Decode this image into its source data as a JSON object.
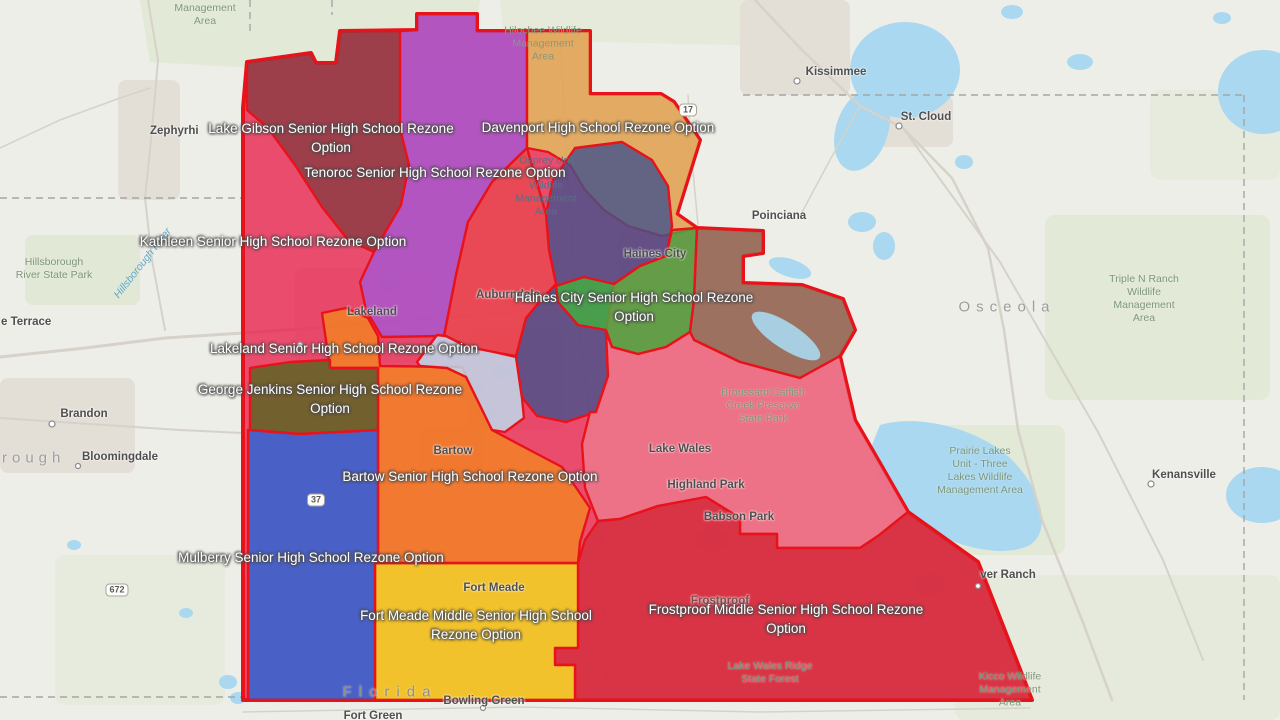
{
  "map": {
    "title": "Polk County school rezone options map",
    "colors": {
      "background": "#edeee7",
      "water": "#a9d8f0",
      "zone_border": "#e8121b",
      "green_area": "#dfe7d3",
      "urban_area": "#e3dfd7",
      "road": "#d6d2c9"
    },
    "zones": [
      {
        "id": "kathleen",
        "name": "Kathleen Senior High School Rezone Option",
        "color": "#e8234f"
      },
      {
        "id": "lake-gibson",
        "name": "Lake Gibson Senior High School Rezone Option",
        "color": "#8a3c42"
      },
      {
        "id": "tenoroc",
        "name": "Tenoroc Senior High School Rezone Option",
        "color": "#a557d4"
      },
      {
        "id": "davenport",
        "name": "Davenport High School Rezone Option",
        "color": "#e0c25f"
      },
      {
        "id": "slate-north",
        "name": "",
        "color": "#44528c"
      },
      {
        "id": "auburndale-red",
        "name": "",
        "color": "#e8494e"
      },
      {
        "id": "haines-city",
        "name": "Haines City Senior High School Rezone Option",
        "color": "#42b13e"
      },
      {
        "id": "east-olive",
        "name": "",
        "color": "#8a7a5c"
      },
      {
        "id": "lake-wales-pink",
        "name": "",
        "color": "#ee7c8d"
      },
      {
        "id": "frostproof",
        "name": "Frostproof Middle Senior High School Rezone Option",
        "color": "#d42e3c"
      },
      {
        "id": "fort-meade",
        "name": "Fort Meade Middle Senior High School Rezone Option",
        "color": "#f2e01c"
      },
      {
        "id": "bartow",
        "name": "Bartow Senior High School Rezone Option",
        "color": "#f28520"
      },
      {
        "id": "george-jenkins",
        "name": "George Jenkins Senior High School Rezone Option",
        "color": "#55651f"
      },
      {
        "id": "mulberry",
        "name": "Mulberry Senior High School Rezone Option",
        "color": "#2066dd"
      },
      {
        "id": "winter-haven",
        "name": "",
        "color": "#bce4f5"
      }
    ],
    "zone_labels": [
      {
        "id": "lake-gibson",
        "x": 331,
        "y": 129,
        "lines": [
          "Lake Gibson Senior High School Rezone",
          "Option"
        ]
      },
      {
        "id": "davenport",
        "x": 598,
        "y": 128,
        "lines": [
          "Davenport High School Rezone Option"
        ]
      },
      {
        "id": "tenoroc",
        "x": 435,
        "y": 173,
        "lines": [
          "Tenoroc Senior High School Rezone Option"
        ]
      },
      {
        "id": "kathleen",
        "x": 273,
        "y": 242,
        "lines": [
          "Kathleen Senior High School Rezone Option"
        ]
      },
      {
        "id": "haines-city",
        "x": 634,
        "y": 298,
        "lines": [
          "Haines City Senior High School Rezone",
          "Option"
        ]
      },
      {
        "id": "lakeland",
        "x": 344,
        "y": 349,
        "lines": [
          "Lakeland Senior High School Rezone Option"
        ]
      },
      {
        "id": "george-jenkins",
        "x": 330,
        "y": 390,
        "lines": [
          "George Jenkins Senior High School Rezone",
          "Option"
        ]
      },
      {
        "id": "bartow",
        "x": 470,
        "y": 477,
        "lines": [
          "Bartow Senior High School Rezone Option"
        ]
      },
      {
        "id": "mulberry",
        "x": 311,
        "y": 558,
        "lines": [
          "Mulberry Senior High School Rezone Option"
        ]
      },
      {
        "id": "fort-meade",
        "x": 476,
        "y": 616,
        "lines": [
          "Fort Meade Middle Senior High School",
          "Rezone Option"
        ]
      },
      {
        "id": "frostproof",
        "x": 786,
        "y": 610,
        "lines": [
          "Frostproof Middle Senior High School Rezone",
          "Option"
        ]
      }
    ],
    "city_labels": [
      {
        "text": "Kissimmee",
        "x": 836,
        "y": 72
      },
      {
        "text": "St. Cloud",
        "x": 926,
        "y": 117
      },
      {
        "text": "Poinciana",
        "x": 779,
        "y": 216
      },
      {
        "text": "Zephyrhi",
        "x": 150,
        "y": 131,
        "anchor": "left"
      },
      {
        "text": "e Terrace",
        "x": 1,
        "y": 322,
        "anchor": "left"
      },
      {
        "text": "Brandon",
        "x": 84,
        "y": 414
      },
      {
        "text": "Bloomingdale",
        "x": 120,
        "y": 457
      },
      {
        "text": "Lakeland",
        "x": 372,
        "y": 312
      },
      {
        "text": "Auburndale",
        "x": 508,
        "y": 295
      },
      {
        "text": "Haines City",
        "x": 655,
        "y": 254
      },
      {
        "text": "Bartow",
        "x": 453,
        "y": 451
      },
      {
        "text": "Fort Meade",
        "x": 494,
        "y": 588
      },
      {
        "text": "Frostproof",
        "x": 720,
        "y": 601,
        "color": "#7c4f52"
      },
      {
        "text": "Lake Wales",
        "x": 680,
        "y": 449
      },
      {
        "text": "Highland Park",
        "x": 706,
        "y": 485
      },
      {
        "text": "Babson Park",
        "x": 739,
        "y": 517
      },
      {
        "text": "Bowling Green",
        "x": 484,
        "y": 701
      },
      {
        "text": "Fort Green",
        "x": 373,
        "y": 716
      },
      {
        "text": "Kenansville",
        "x": 1184,
        "y": 475
      },
      {
        "text": "ver Ranch",
        "x": 1008,
        "y": 575
      }
    ],
    "park_labels": [
      {
        "x": 205,
        "y": 15,
        "lines": [
          "Management",
          "Area"
        ]
      },
      {
        "x": 54,
        "y": 269,
        "lines": [
          "Hillsborough",
          "River State Park"
        ]
      },
      {
        "x": 1144,
        "y": 299,
        "lines": [
          "Triple N Ranch",
          "Wildlife",
          "Management",
          "Area"
        ]
      },
      {
        "x": 980,
        "y": 471,
        "lines": [
          "Prairie Lakes",
          "Unit - Three",
          "Lakes Wildlife",
          "Management Area"
        ]
      },
      {
        "x": 763,
        "y": 406,
        "lines": [
          "Broussard Catfish",
          "Creek Preserve",
          "State Park"
        ]
      },
      {
        "x": 770,
        "y": 673,
        "lines": [
          "Lake Wales Ridge",
          "State Forest"
        ]
      },
      {
        "x": 1010,
        "y": 690,
        "lines": [
          "Kicco Wildlife",
          "Management",
          "Area"
        ]
      }
    ],
    "ghost_labels": [
      {
        "x": 543,
        "y": 44,
        "color": "#8a977f",
        "lines": [
          "Hilochee Wildlife",
          "Management",
          "Area"
        ]
      },
      {
        "x": 547,
        "y": 161,
        "color": "#5f6b85",
        "lines": [
          "Osprey Unit"
        ]
      },
      {
        "x": 546,
        "y": 199,
        "color": "#5f6b85",
        "lines": [
          "Wildlife",
          "Management",
          "Area"
        ]
      }
    ],
    "area_labels": [
      {
        "text": "Osceola",
        "x": 1007,
        "y": 307,
        "ls": 6,
        "size": 15,
        "color": "#9c9c9c"
      },
      {
        "text": "Florida",
        "x": 390,
        "y": 692,
        "ls": 7,
        "size": 15,
        "color": "#8e8e8e"
      },
      {
        "text": "rough",
        "x": 2,
        "y": 458,
        "ls": 5,
        "size": 15,
        "color": "#9e9e9e",
        "anchor": "left"
      }
    ],
    "route_shields": [
      {
        "label": "17",
        "x": 688,
        "y": 110
      },
      {
        "label": "37",
        "x": 316,
        "y": 500
      },
      {
        "label": "672",
        "x": 117,
        "y": 590
      }
    ],
    "river_label": {
      "text": "Hillsborough River"
    }
  }
}
